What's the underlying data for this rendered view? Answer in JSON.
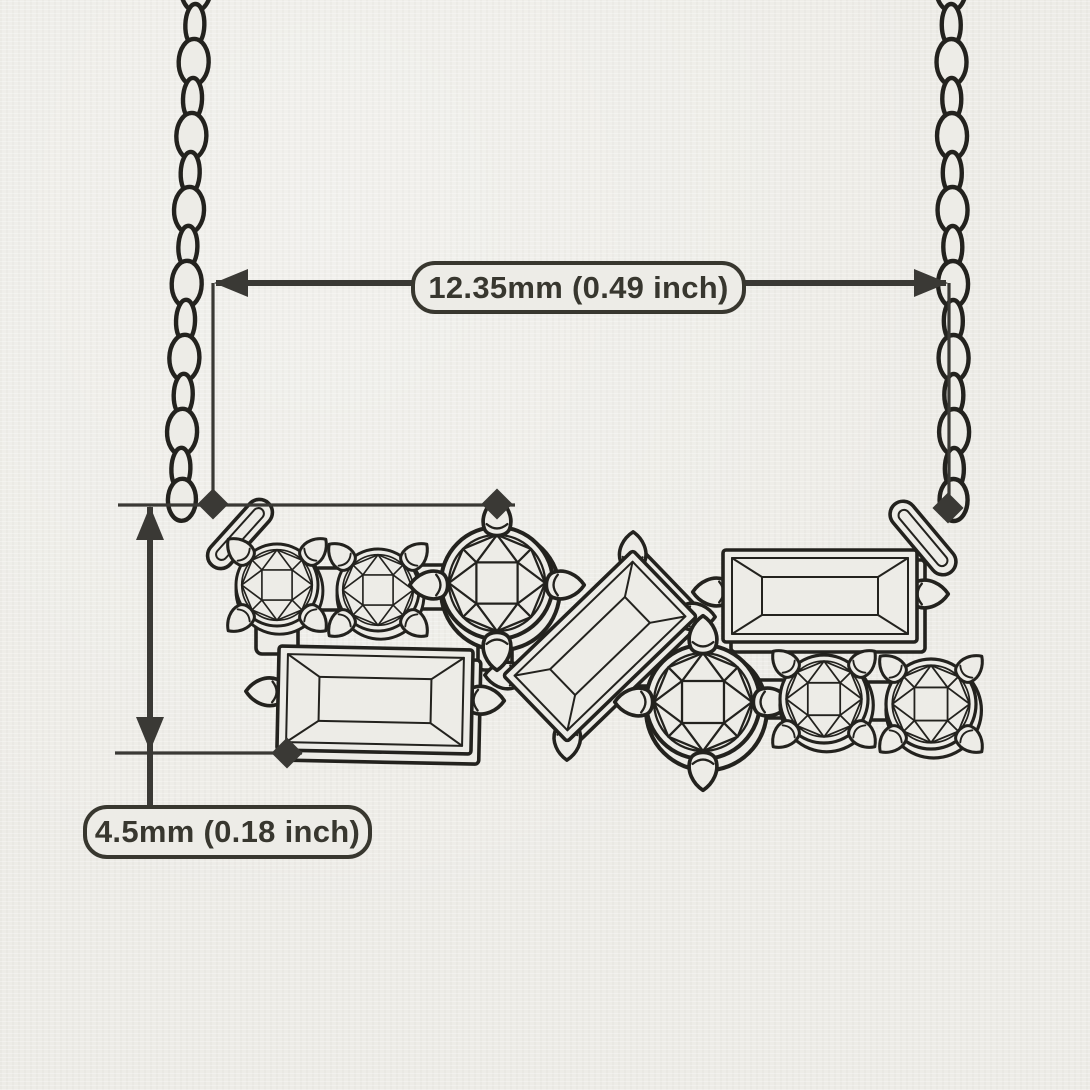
{
  "diagram": {
    "subject": "Cluster bar pendant necklace technical line drawing with dimension callouts",
    "style": "black ink sketch on textured paper",
    "colors": {
      "paper": "#edece7",
      "ink": "#23221e",
      "dimension": "#3a3935"
    },
    "dimensions": {
      "width": {
        "mm": 12.35,
        "inch": 0.49,
        "label": "12.35mm (0.49 inch)"
      },
      "height": {
        "mm": 4.5,
        "inch": 0.18,
        "label": "4.5mm (0.18 inch)"
      }
    },
    "chain": {
      "style": "cable link chain",
      "count": 2,
      "positions": [
        "left",
        "right"
      ]
    },
    "stones": [
      {
        "id": 1,
        "cut": "round brilliant",
        "row": "top",
        "position": "far-left",
        "size": "small"
      },
      {
        "id": 2,
        "cut": "round brilliant",
        "row": "top",
        "position": "left",
        "size": "small"
      },
      {
        "id": 3,
        "cut": "round brilliant",
        "row": "top",
        "position": "center-left",
        "size": "large"
      },
      {
        "id": 4,
        "cut": "baguette",
        "row": "bottom",
        "position": "left",
        "orientation": "horizontal"
      },
      {
        "id": 5,
        "cut": "baguette",
        "row": "middle",
        "position": "center",
        "orientation": "tilted"
      },
      {
        "id": 6,
        "cut": "baguette",
        "row": "top",
        "position": "right",
        "orientation": "horizontal"
      },
      {
        "id": 7,
        "cut": "round brilliant",
        "row": "bottom",
        "position": "center-right",
        "size": "large"
      },
      {
        "id": 8,
        "cut": "round brilliant",
        "row": "bottom",
        "position": "right",
        "size": "small"
      },
      {
        "id": 9,
        "cut": "round brilliant",
        "row": "bottom",
        "position": "far-right",
        "size": "small"
      }
    ]
  }
}
